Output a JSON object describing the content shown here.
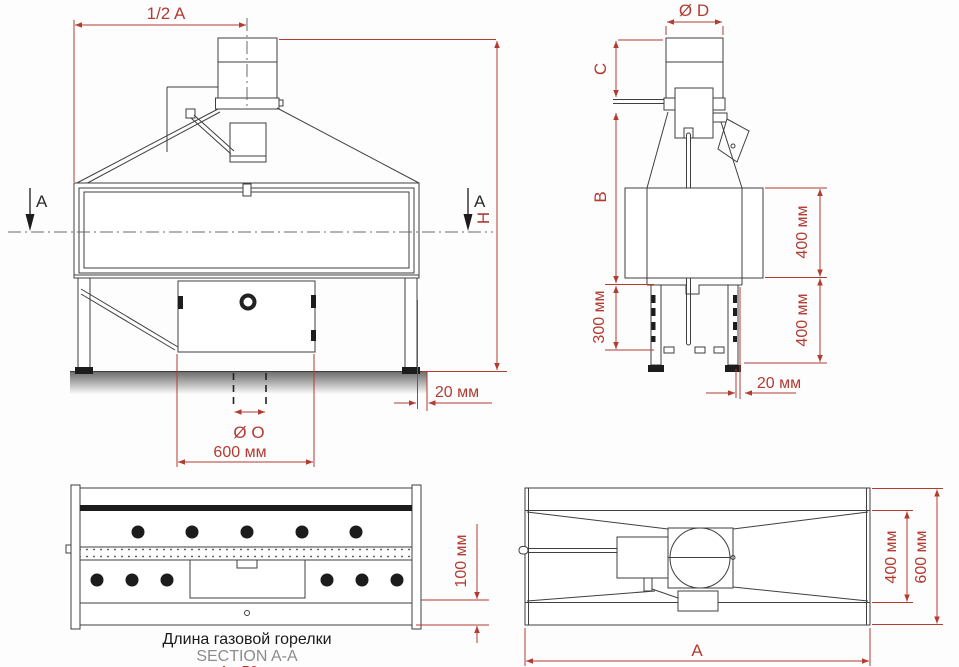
{
  "colors": {
    "dimension_red": "#b23b32",
    "line_dark": "#3f3f3f",
    "caption_gray": "#8c8c8c",
    "text_black": "#1a1a1a"
  },
  "front_view": {
    "dim_half_a": "1/2 A",
    "section_marker_left": "A",
    "section_marker_right": "A",
    "dim_h": "H",
    "dim_20mm": "20 мм",
    "dim_dia_o": "Ø O",
    "dim_600mm": "600 мм"
  },
  "side_view": {
    "dim_dia_d": "Ø D",
    "dim_c": "C",
    "dim_b": "B",
    "dim_400mm_upper": "400 мм",
    "dim_300mm": "300 мм",
    "dim_400mm_lower": "400 мм",
    "dim_20mm": "20 мм"
  },
  "section_view": {
    "dim_100mm": "100 мм",
    "caption_title": "Длина газовой горелки",
    "caption_section": "SECTION A-A",
    "caption_burner": "A - 50 мм"
  },
  "top_view": {
    "dim_400mm": "400 мм",
    "dim_600mm": "600 мм",
    "dim_a": "A"
  }
}
